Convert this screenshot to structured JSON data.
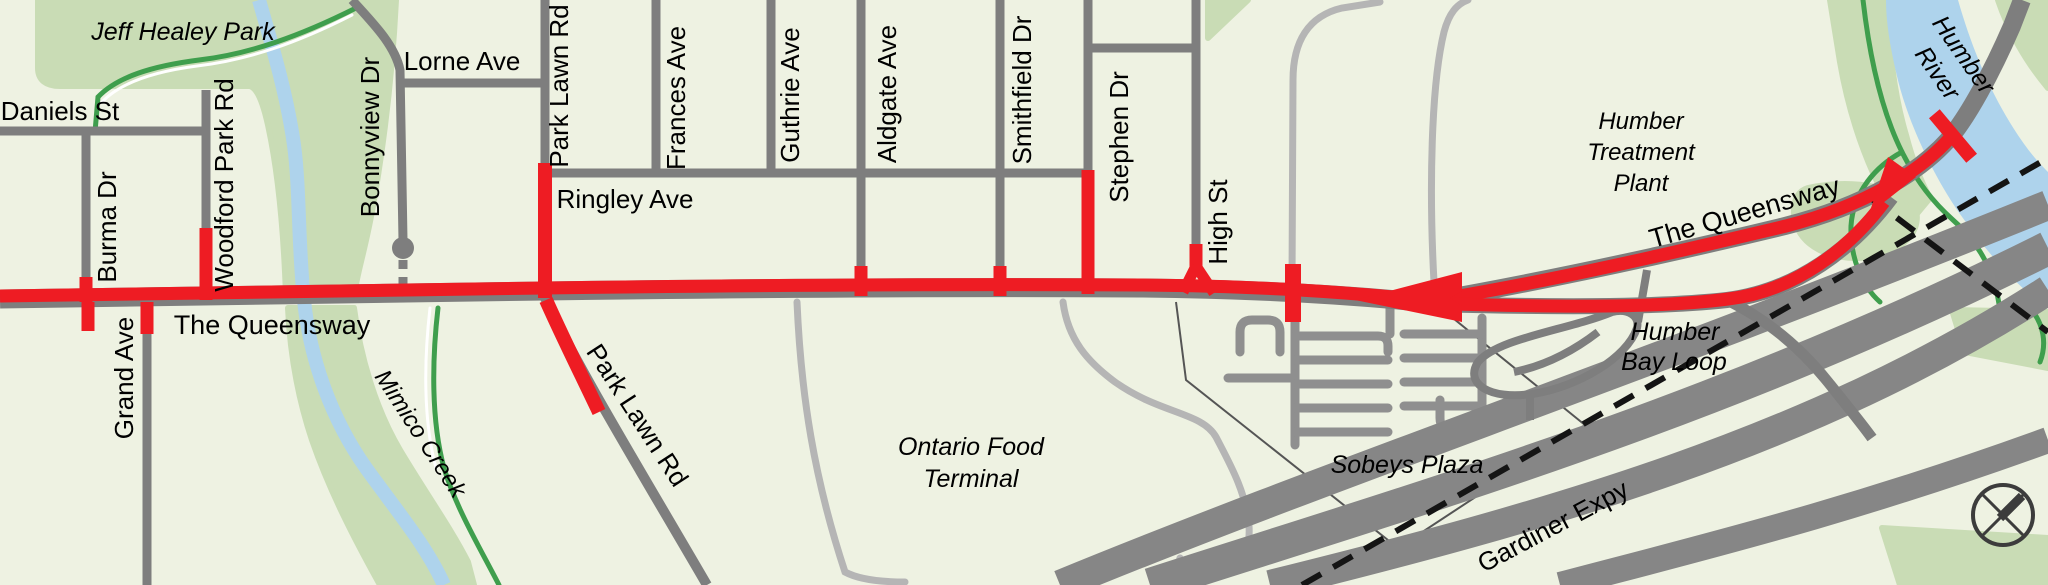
{
  "map": {
    "description": "Street map of The Queensway corridor with highlighted transit route",
    "colors": {
      "background": "#eef2e2",
      "park_green": "#c9dcb5",
      "water_blue": "#aed3ec",
      "trail_green": "#3f9e4d",
      "road_gray": "#7e7e7e",
      "road_minor_gray": "#b5b5b5",
      "parking_gray": "#8f8f8f",
      "expressway_gray": "#868686",
      "route_red": "#ee1c23",
      "rail_dash_black": "#141414",
      "label_black": "#000000"
    }
  },
  "labels": {
    "jeff_healey_park": "Jeff Healey Park",
    "daniels_st": "Daniels St",
    "burma_dr": "Burma Dr",
    "woodford_park_rd": "Woodford Park Rd",
    "bonnyview_dr": "Bonnyview Dr",
    "lorne_ave": "Lorne Ave",
    "park_lawn_rd_n": "Park Lawn Rd",
    "frances_ave": "Frances Ave",
    "guthrie_ave": "Guthrie Ave",
    "aldgate_ave": "Aldgate Ave",
    "smithfield_dr": "Smithfield Dr",
    "stephen_dr": "Stephen Dr",
    "high_st": "High St",
    "ringley_ave": "Ringley Ave",
    "queensway_left": "The Queensway",
    "queensway_right": "The Queensway",
    "grand_ave": "Grand Ave",
    "park_lawn_rd_s": "Park Lawn Rd",
    "mimico_creek": "Mimico Creek",
    "ontario_food_1": "Ontario Food",
    "ontario_food_2": "Terminal",
    "sobeys_plaza": "Sobeys Plaza",
    "humber_treatment_1": "Humber",
    "humber_treatment_2": "Treatment",
    "humber_treatment_3": "Plant",
    "humber_bay_1": "Humber",
    "humber_bay_2": "Bay Loop",
    "gardiner_expy": "Gardiner Expy",
    "humber_river_1": "Humber",
    "humber_river_2": "River"
  }
}
